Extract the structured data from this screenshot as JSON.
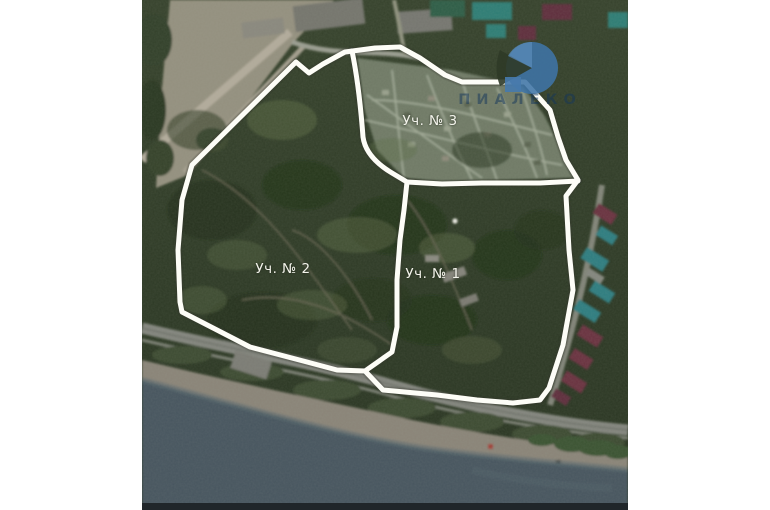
{
  "window": {
    "width": 770,
    "height": 510,
    "background": "#ffffff"
  },
  "map": {
    "kind": "satellite-photo-with-plot-boundary-overlay",
    "plot_labels": [
      {
        "id": "plot-1",
        "label": "Уч. № 1"
      },
      {
        "id": "plot-2",
        "label": "Уч. № 2"
      },
      {
        "id": "plot-3",
        "label": "Уч. № 3"
      }
    ],
    "watermark": {
      "text": "ПИАЛЕКО",
      "logo": "blue-crescent-circle-logo",
      "marker": "blue-square"
    },
    "colors": {
      "boundary_line": "#fdfdf7",
      "forest": "#2f3a27",
      "forest_dark": "#222e1a",
      "forest_light": "#55663f",
      "sea": "#46555e",
      "quarry_gray": "#95907f",
      "road_gray": "#84867e",
      "beach": "#8a8478",
      "settlement": "#737e66",
      "settlement_path": "#a9b19e",
      "roof_teal": "#2f7d80",
      "roof_maroon": "#6b3140",
      "roof_green": "#2e5d46",
      "watermark_blue": "#3f74a6",
      "watermark_text": "#14365c",
      "bottom_band": "#20262a"
    }
  }
}
